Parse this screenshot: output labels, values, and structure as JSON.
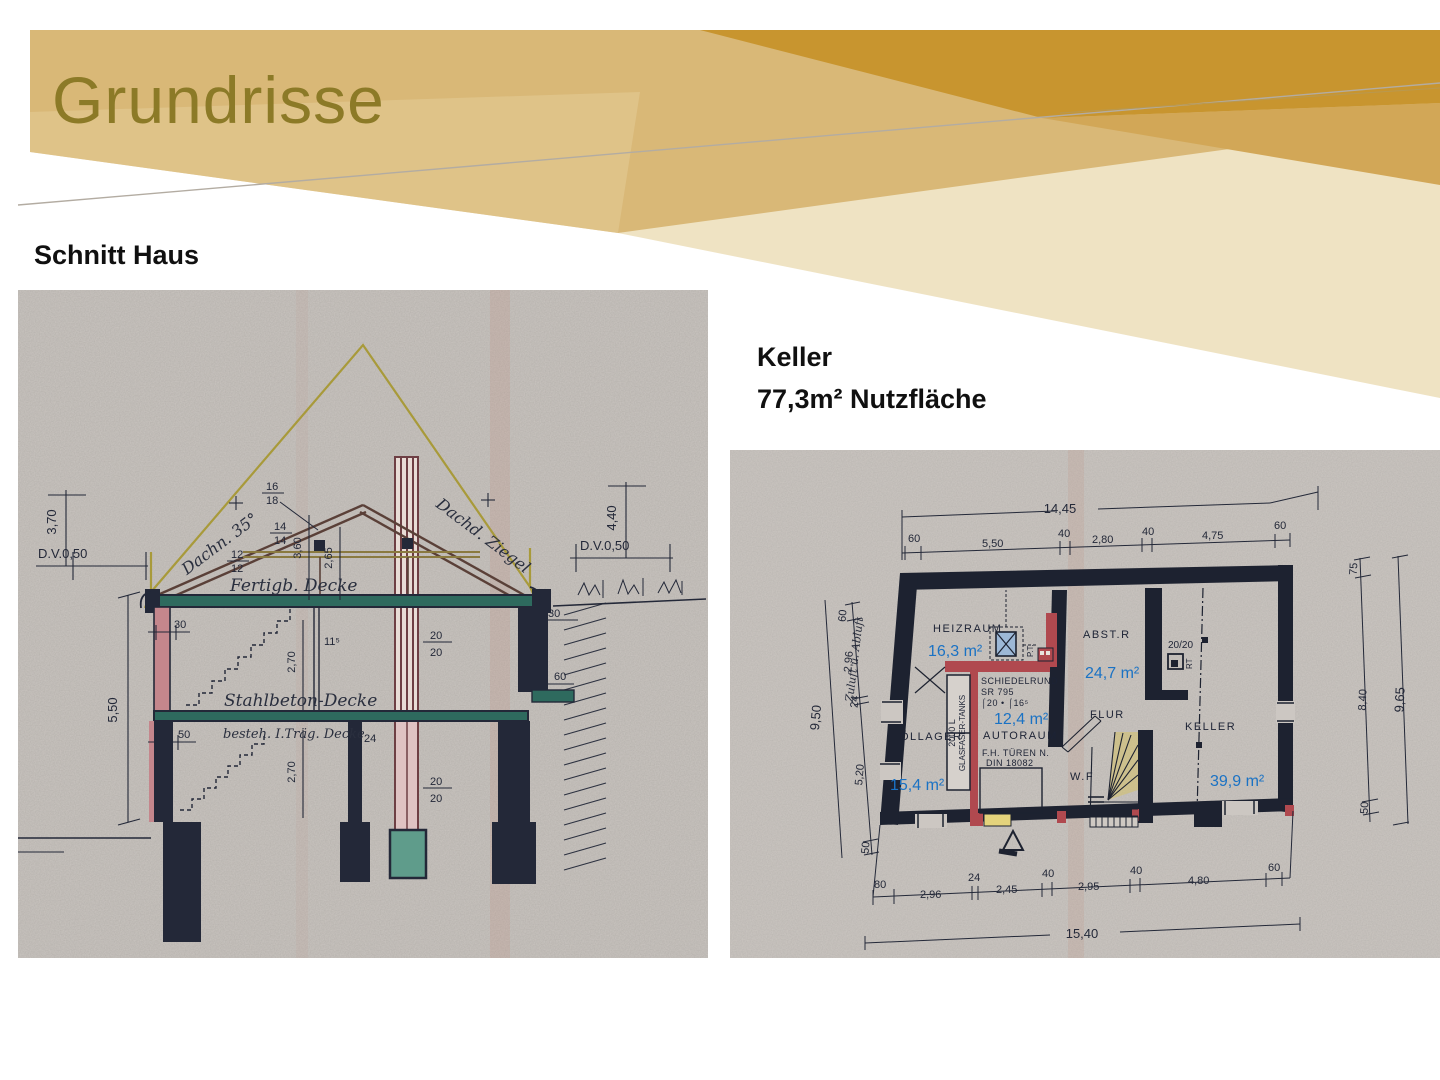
{
  "slide": {
    "title": "Grundrisse",
    "captions": {
      "left": "Schnitt Haus",
      "right_line1": "Keller",
      "right_line2": "77,3m² Nutzfläche"
    },
    "colors": {
      "band": "#d9b877",
      "gold_dark": "#c8952f",
      "gold_mid": "#d2a757",
      "cream": "#efe3c3",
      "title": "#8c7a27",
      "ink": "#232838",
      "teal": "#2e6a5e",
      "red": "#a7454d",
      "blue": "#1a72c4",
      "yellow": "#b2a135"
    }
  },
  "section": {
    "dims": {
      "dv": "D.V.0,50",
      "h370": "3,70",
      "h440": "4,40",
      "h550": "5,50",
      "h360": "3,60",
      "h265": "2,65",
      "h270a": "2,70",
      "h270b": "2,70",
      "w30": "30",
      "w30b": "30",
      "w60": "60",
      "w50": "50",
      "w24": "24",
      "t115": "11⁵",
      "f16": "16",
      "f18": "18",
      "f12a": "12",
      "f12b": "12",
      "f14a": "14",
      "f14b": "14",
      "c20a": "20",
      "c20b": "20",
      "c20c": "20",
      "c20d": "20"
    },
    "labels": {
      "roof_angle": "Dachn. 35°",
      "roof_tile": "Dachd. Ziegel",
      "ceiling1": "Fertigb. Decke",
      "ceiling2": "Stahlbeton-Decke",
      "ceiling3": "besteh. I.Träg. Decke"
    }
  },
  "plan": {
    "dims_top": {
      "total": "14,45",
      "s1": "60",
      "s2": "5,50",
      "s3": "40",
      "s4": "2,80",
      "s5": "40",
      "s6": "4,75",
      "s7": "60"
    },
    "dims_left": {
      "total": "9,50",
      "s1": "60",
      "s2": "2,96",
      "s3": "24",
      "s4": "5,20",
      "s5": "50"
    },
    "dims_right": {
      "total": "9,65",
      "s1": "75",
      "s2": "8,40",
      "s3": "50"
    },
    "dims_bottom": {
      "total": "15,40",
      "s1": "80",
      "s2": "2,96",
      "s3": "24",
      "s4": "2,45",
      "s5": "40",
      "s6": "2,95",
      "s7": "40",
      "s8": "4,80",
      "s9": "60"
    },
    "rooms": {
      "heizraum": "HEIZRAUM",
      "heizraum_area": "16,3 m²",
      "abstr": "ABST.R",
      "abstr_area": "24,7 m²",
      "oellager": "ÖLLAGER",
      "oellager_area": "15,4 m²",
      "autoraum": "AUTORAUM",
      "autoraum_area": "12,4 m²",
      "flur": "FLUR",
      "wf": "W.F",
      "keller": "KELLER",
      "keller_area": "39,9 m²"
    },
    "notes": {
      "zuluft": "Zuluft u. Abluft",
      "schiedel1": "SCHIEDELRUND",
      "schiedel2": "SR 795",
      "schiedel3": "⌠20 • ⌠16⁵",
      "tank1": "2000 L",
      "tank2": "GLASFASER-TANKS",
      "tueren1": "F.H. TÜREN N.",
      "tueren2": "DIN 18082",
      "grid": "20/20",
      "rt": "RT",
      "pt": "P.T."
    }
  }
}
